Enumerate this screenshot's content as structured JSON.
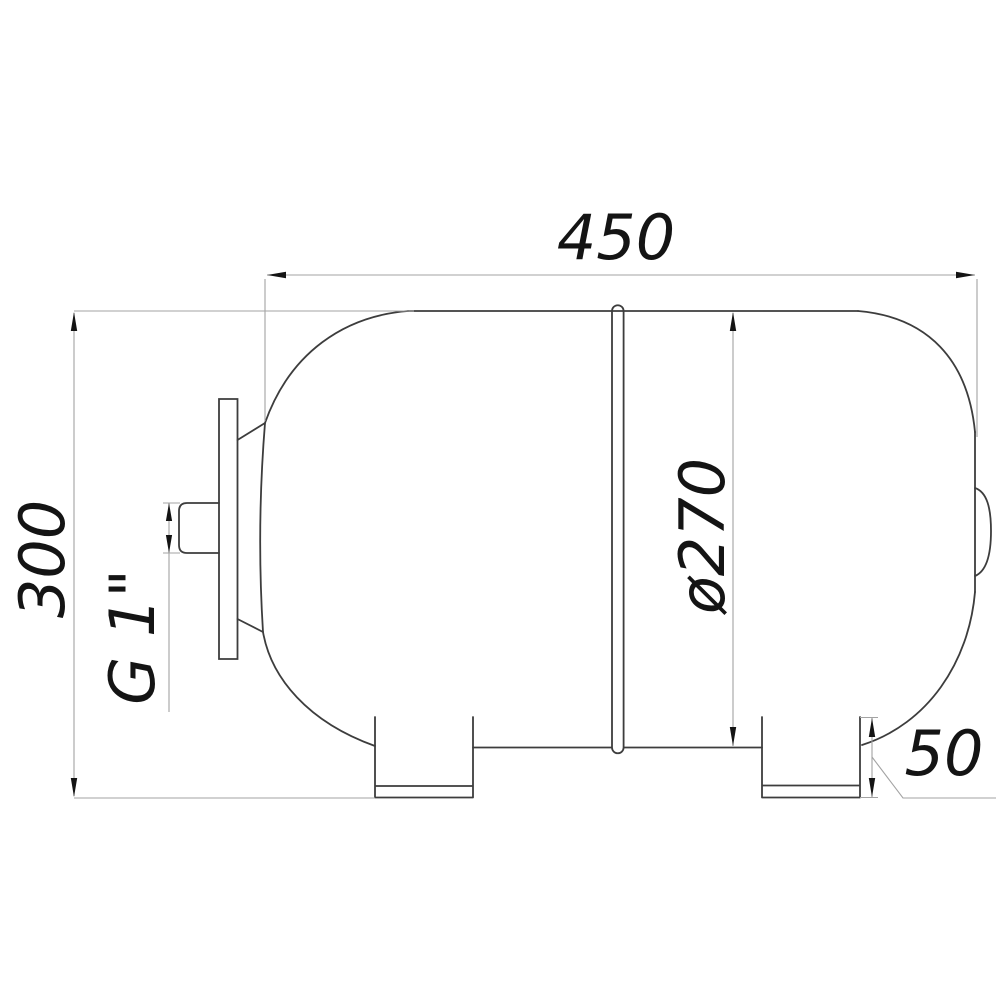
{
  "drawing": {
    "title": "horizontal expansion tank dimension drawing",
    "labels": {
      "length": "450",
      "height": "300",
      "diameter": "ø270",
      "foot_height": "50",
      "thread": "G 1\""
    },
    "colors": {
      "background": "#ffffff",
      "outline": "#3d3d3d",
      "dim_line": "#a3a3a3",
      "arrow": "#141414",
      "text": "#141414"
    }
  }
}
